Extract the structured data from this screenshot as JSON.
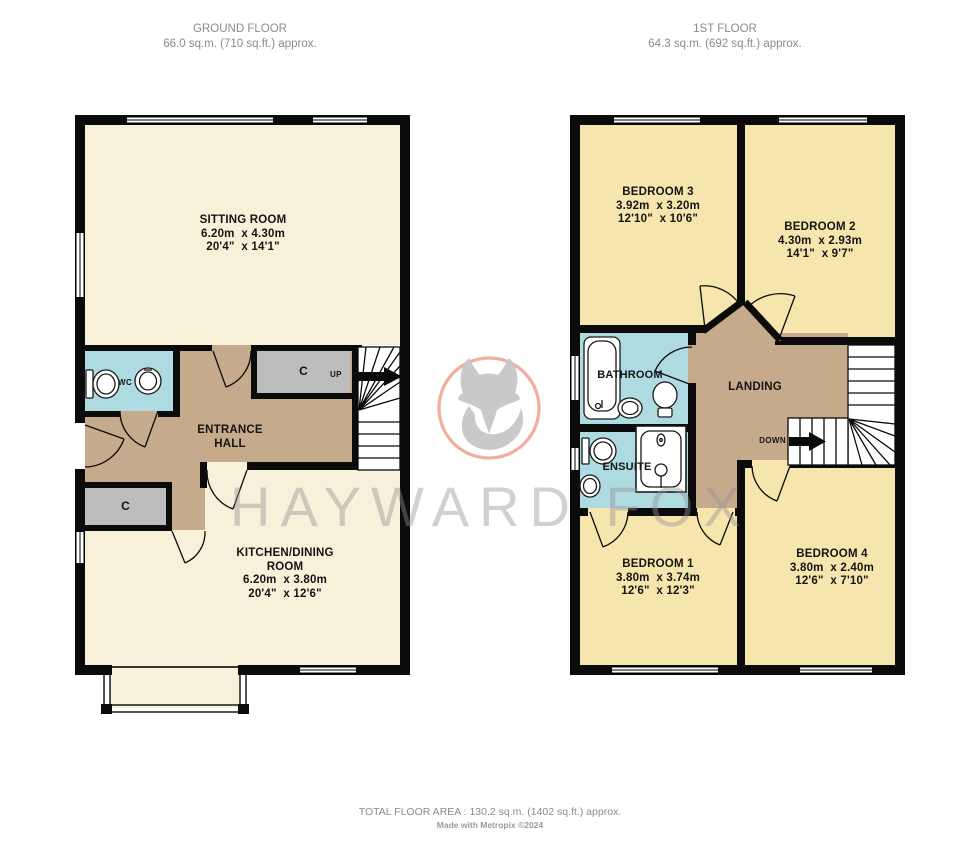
{
  "headers": {
    "ground": {
      "title": "GROUND FLOOR",
      "area": "66.0 sq.m. (710 sq.ft.) approx."
    },
    "first": {
      "title": "1ST FLOOR",
      "area": "64.3 sq.m. (692 sq.ft.) approx."
    }
  },
  "ground": {
    "sitting_room": {
      "name": "SITTING ROOM",
      "metric": "6.20m  x 4.30m",
      "imperial": "20'4\"  x 14'1\""
    },
    "entrance_hall": {
      "line1": "ENTRANCE",
      "line2": "HALL"
    },
    "kitchen": {
      "line1": "KITCHEN/DINING",
      "line2": "ROOM",
      "metric": "6.20m  x 3.80m",
      "imperial": "20'4\"  x 12'6\""
    },
    "wc_label": "WC",
    "closet_top": "C",
    "closet_side": "C",
    "stair_label": "UP"
  },
  "first": {
    "bedroom3": {
      "name": "BEDROOM 3",
      "metric": "3.92m  x 3.20m",
      "imperial": "12'10\"  x 10'6\""
    },
    "bedroom2": {
      "name": "BEDROOM 2",
      "metric": "4.30m  x 2.93m",
      "imperial": "14'1\"  x 9'7\""
    },
    "bedroom1": {
      "name": "BEDROOM 1",
      "metric": "3.80m  x 3.74m",
      "imperial": "12'6\"  x 12'3\""
    },
    "bedroom4": {
      "name": "BEDROOM 4",
      "metric": "3.80m  x 2.40m",
      "imperial": "12'6\"  x 7'10\""
    },
    "bathroom_label": "BATHROOM",
    "ensuite_label": "ENSUITE",
    "landing_label": "LANDING",
    "stair_label": "DOWN"
  },
  "watermark": {
    "brand": "HAYWARD FOX"
  },
  "footer": {
    "total_area": "TOTAL FLOOR AREA : 130.2 sq.m. (1402 sq.ft.) approx.",
    "credit": "Made with Metropix ©2024"
  },
  "colors": {
    "room_cream": "#f7f1da",
    "room_yellow": "#f6e6ae",
    "hall_tan": "#c5ab8c",
    "wet_blue": "#aedae2",
    "closet_gray": "#bdbdbd",
    "wall_black": "#0b0b0b",
    "watermark_gray": "#c8c8c8",
    "logo_circle_salmon": "#f2aca2"
  }
}
